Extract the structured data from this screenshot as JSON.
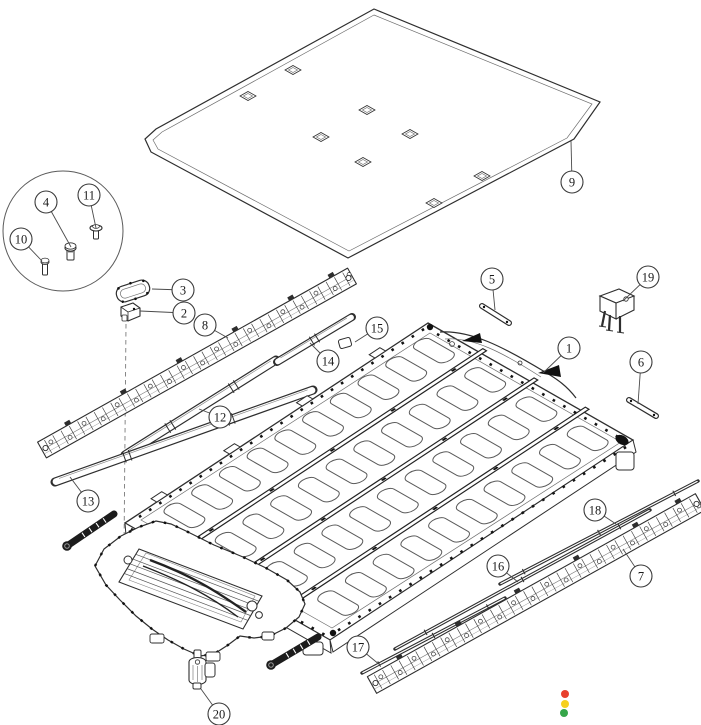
{
  "figure": {
    "kind": "exploded-assembly-diagram",
    "subject": "battery-pack-exploded-view",
    "canvas": {
      "width": 701,
      "height": 725,
      "background": "#ffffff"
    },
    "style": {
      "line_color": "#2e2e2e",
      "thin_line_color": "#808080",
      "leader_color": "#4a4a4a",
      "callout_fill": "#ffffff",
      "callout_stroke": "#3a3a3a",
      "callout_radius": 11,
      "callout_font_px": 12.5
    },
    "callouts": [
      {
        "n": "1",
        "cx": 569,
        "cy": 348,
        "tx": 543,
        "ty": 373
      },
      {
        "n": "2",
        "cx": 184,
        "cy": 313,
        "tx": 140,
        "ty": 311
      },
      {
        "n": "3",
        "cx": 183,
        "cy": 290,
        "tx": 152,
        "ty": 289
      },
      {
        "n": "4",
        "cx": 46,
        "cy": 202,
        "tx": 71,
        "ty": 247
      },
      {
        "n": "5",
        "cx": 492,
        "cy": 279,
        "tx": 495,
        "ty": 310
      },
      {
        "n": "6",
        "cx": 641,
        "cy": 362,
        "tx": 638,
        "ty": 404
      },
      {
        "n": "7",
        "cx": 641,
        "cy": 576,
        "tx": 623,
        "ty": 549
      },
      {
        "n": "8",
        "cx": 205,
        "cy": 325,
        "tx": 228,
        "ty": 338
      },
      {
        "n": "9",
        "cx": 572,
        "cy": 182,
        "tx": 571,
        "ty": 141
      },
      {
        "n": "10",
        "cx": 21,
        "cy": 239,
        "tx": 42,
        "ty": 261
      },
      {
        "n": "11",
        "cx": 89,
        "cy": 195,
        "tx": 96,
        "ty": 228
      },
      {
        "n": "12",
        "cx": 220,
        "cy": 417,
        "tx": 199,
        "ty": 409
      },
      {
        "n": "13",
        "cx": 88,
        "cy": 501,
        "tx": 70,
        "ty": 477
      },
      {
        "n": "14",
        "cx": 328,
        "cy": 361,
        "tx": 310,
        "ty": 343
      },
      {
        "n": "15",
        "cx": 377,
        "cy": 328,
        "tx": 355,
        "ty": 342
      },
      {
        "n": "16",
        "cx": 498,
        "cy": 566,
        "tx": 518,
        "ty": 582
      },
      {
        "n": "17",
        "cx": 358,
        "cy": 647,
        "tx": 380,
        "ty": 665
      },
      {
        "n": "18",
        "cx": 595,
        "cy": 510,
        "tx": 616,
        "ty": 524
      },
      {
        "n": "19",
        "cx": 648,
        "cy": 277,
        "tx": 623,
        "ty": 301
      },
      {
        "n": "20",
        "cx": 219,
        "cy": 714,
        "tx": 201,
        "ty": 689
      }
    ],
    "status_dots": [
      {
        "color": "#e8402d",
        "cx": 565,
        "cy": 694,
        "r": 4
      },
      {
        "color": "#f6d01e",
        "cx": 565,
        "cy": 704,
        "r": 4
      },
      {
        "color": "#36a64a",
        "cx": 564,
        "cy": 713,
        "r": 4
      }
    ]
  }
}
